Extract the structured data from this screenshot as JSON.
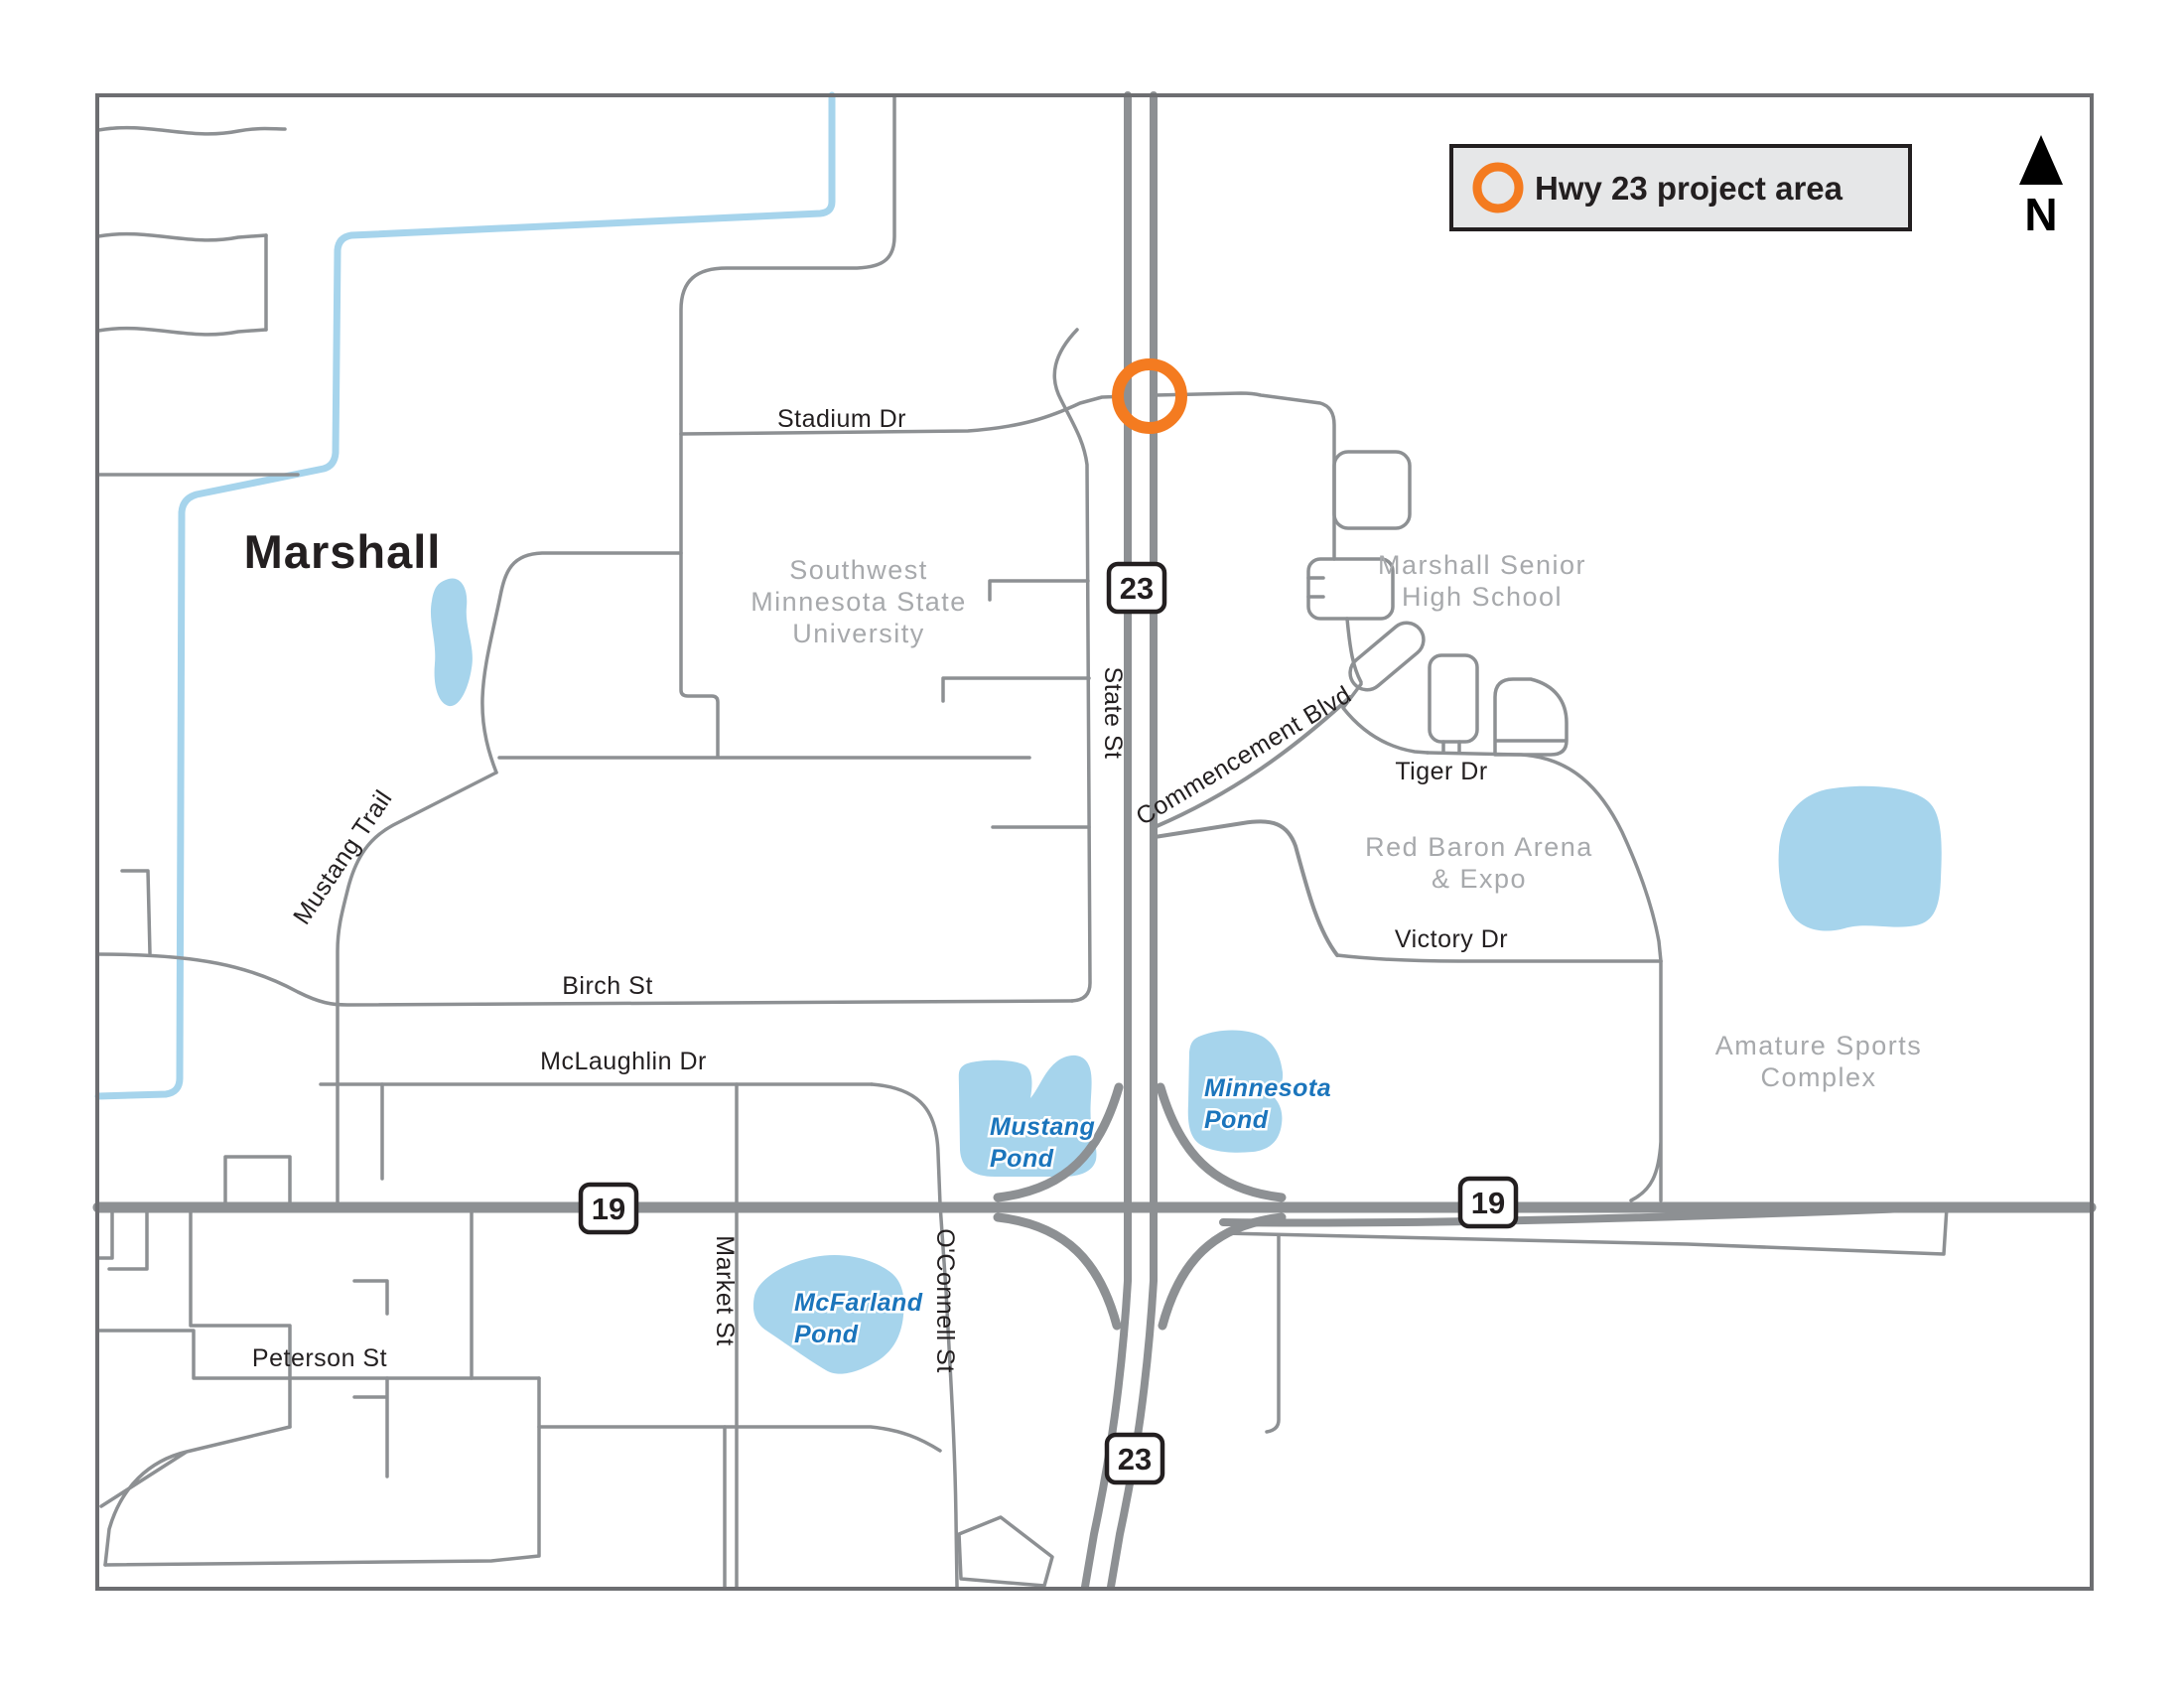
{
  "legend": {
    "label": "Hwy 23 project area",
    "icon": "project-area-ring-icon"
  },
  "compass": {
    "label": "N",
    "icon": "north-arrow-icon"
  },
  "city": {
    "label": "Marshall"
  },
  "roads": {
    "stadium": "Stadium Dr",
    "state": "State St",
    "commencement": "Commencement Blvd",
    "tiger": "Tiger Dr",
    "victory": "Victory Dr",
    "birch": "Birch St",
    "mclaughlin": "McLaughlin Dr",
    "mustang_trail": "Mustang Trail",
    "market": "Market St",
    "oconnell": "O'Connell St",
    "peterson": "Peterson St"
  },
  "shields": {
    "hwy23_north": "23",
    "hwy23_south": "23",
    "hwy19_west": "19",
    "hwy19_east": "19"
  },
  "areas": {
    "smsu": {
      "line1": "Southwest",
      "line2": "Minnesota State",
      "line3": "University"
    },
    "high_school": {
      "line1": "Marshall Senior",
      "line2": "High School"
    },
    "red_baron": {
      "line1": "Red Baron Arena",
      "line2": "& Expo"
    },
    "sports_complex": {
      "line1": "Amature Sports",
      "line2": "Complex"
    }
  },
  "waters": {
    "mustang_pond": {
      "line1": "Mustang",
      "line2": "Pond"
    },
    "minnesota_pond": {
      "line1": "Minnesota",
      "line2": "Pond"
    },
    "mcfarland_pond": {
      "line1": "McFarland",
      "line2": "Pond"
    }
  },
  "colors": {
    "road_gray": "#8d9093",
    "water_blue": "#a6d4ec",
    "water_label_blue": "#1b75bc",
    "area_label_gray": "#a7a9ac",
    "project_orange": "#f47b20",
    "legend_background": "#e6e7e8",
    "ink_black": "#231f20",
    "frame_gray": "#6d6e71"
  }
}
